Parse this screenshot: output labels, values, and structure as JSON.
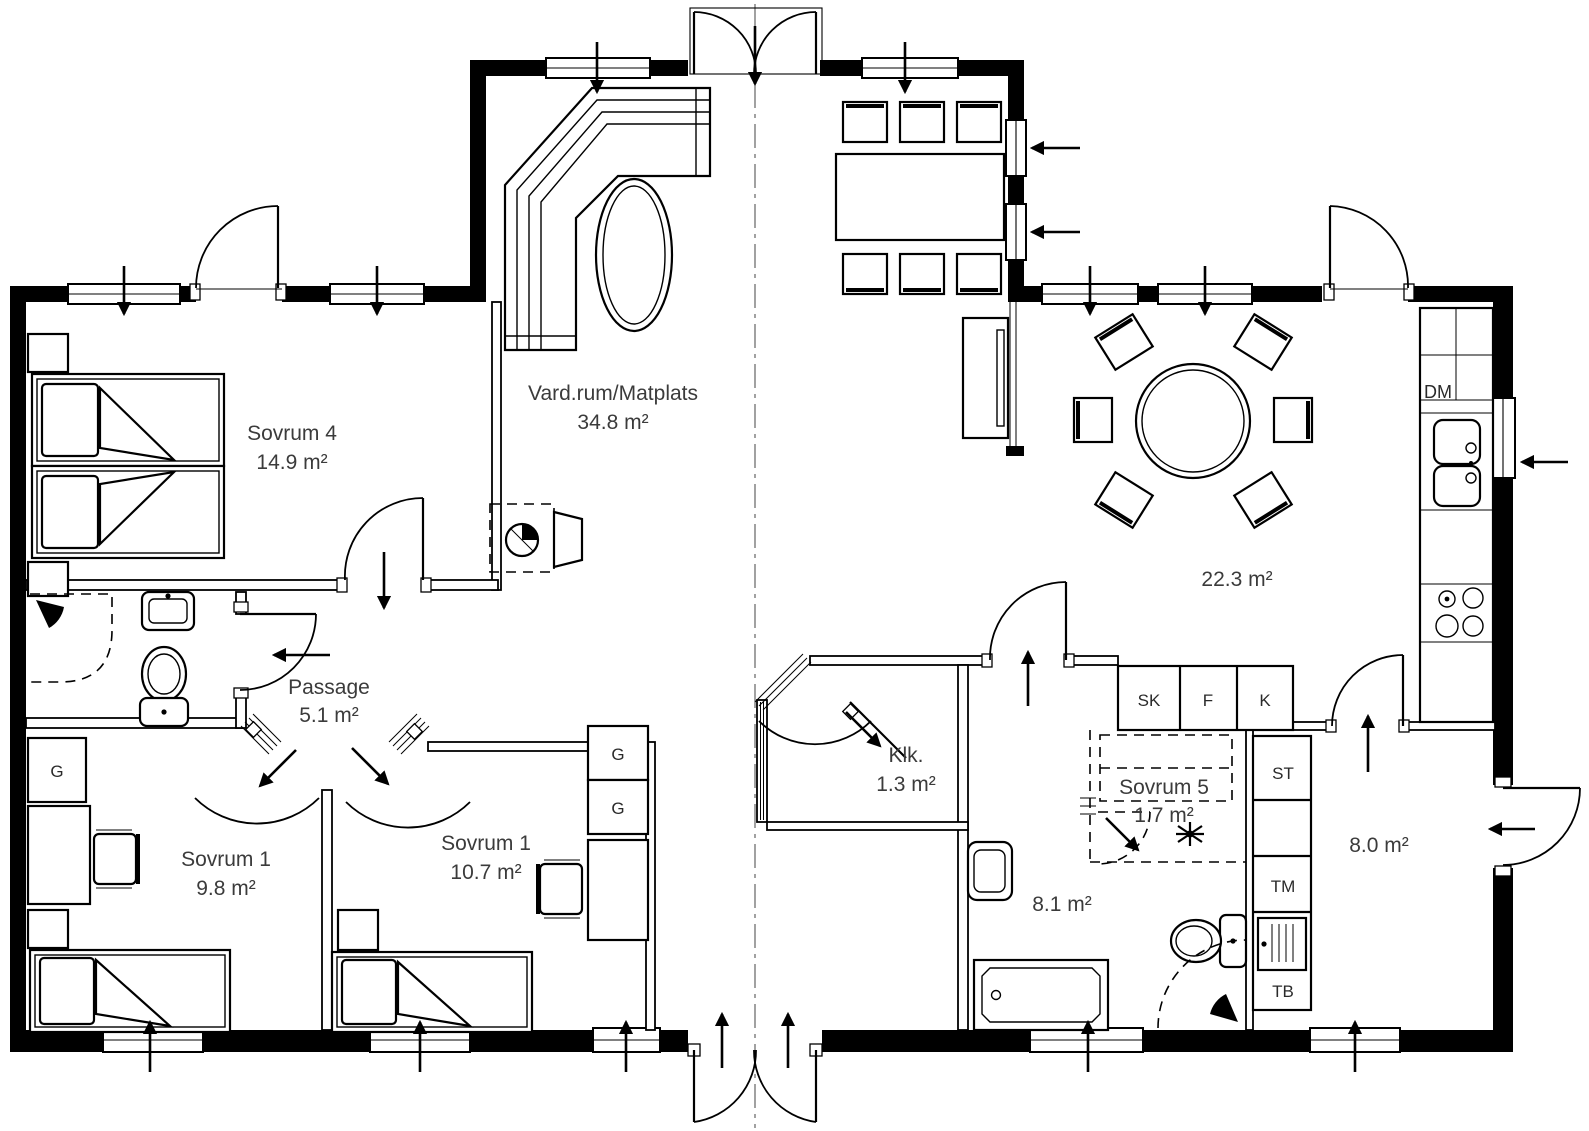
{
  "plan": {
    "rooms": {
      "sovrum4": {
        "name": "Sovrum 4",
        "area": "14.9 m²"
      },
      "vardagsrum": {
        "name": "Vard.rum/Matplats",
        "area": "34.8 m²"
      },
      "kok_matplats": {
        "area": "22.3 m²"
      },
      "passage": {
        "name": "Passage",
        "area": "5.1 m²"
      },
      "sovrum1_vast": {
        "name": "Sovrum 1",
        "area": "9.8 m²"
      },
      "sovrum1_mitt": {
        "name": "Sovrum 1",
        "area": "10.7 m²"
      },
      "klk": {
        "name": "Klk.",
        "area": "1.3 m²"
      },
      "sovrum5": {
        "name": "Sovrum 5",
        "area": "1.7 m²"
      },
      "badrum": {
        "area": "8.1 m²"
      },
      "hall": {
        "area": "8.0 m²"
      }
    },
    "fixtures": {
      "dm": "DM",
      "sk": "SK",
      "f": "F",
      "k": "K",
      "st": "ST",
      "tm": "TM",
      "tb": "TB",
      "g": "G"
    },
    "colors": {
      "line": "#000000",
      "text": "#3b3b3b",
      "background": "#ffffff"
    }
  }
}
